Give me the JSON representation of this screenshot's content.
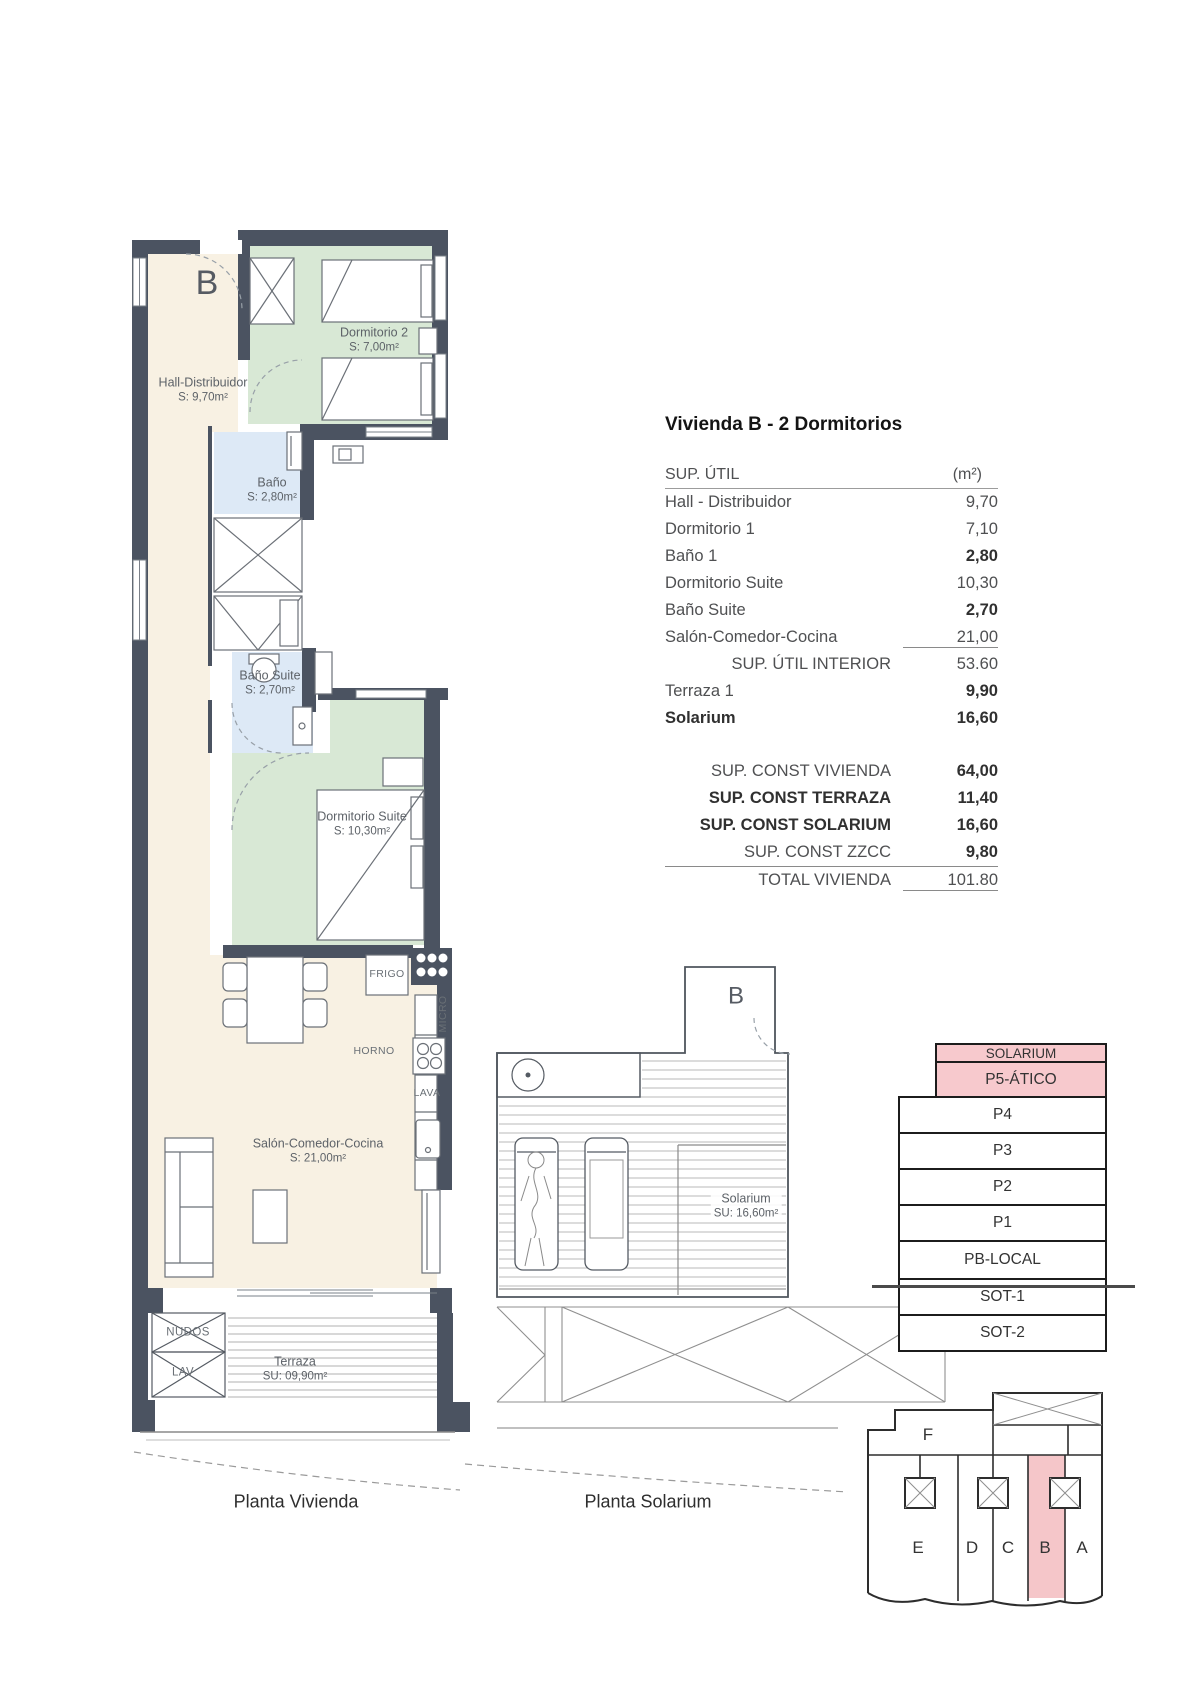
{
  "title": "Vivienda B - 2 Dormitorios",
  "plan_vivienda": {
    "caption": "Planta Vivienda",
    "unit_letter": "B",
    "hall": {
      "name": "Hall-Distribuidor",
      "area": "S: 9,70m²"
    },
    "dorm2": {
      "name": "Dormitorio 2",
      "area": "S: 7,00m²"
    },
    "bano": {
      "name": "Baño",
      "area": "S: 2,80m²"
    },
    "bano_suite": {
      "name": "Baño Suite",
      "area": "S: 2,70m²"
    },
    "dorm_suite": {
      "name": "Dormitorio Suite",
      "area": "S: 10,30m²"
    },
    "salon": {
      "name": "Salón-Comedor-Cocina",
      "area": "S: 21,00m²"
    },
    "terraza": {
      "name": "Terraza",
      "area": "SU: 09,90m²"
    },
    "kitchen_labels": {
      "frigo": "FRIGO",
      "micro": "MICRO",
      "horno": "HORNO",
      "lava": "LAVA"
    },
    "shafts": {
      "top": "NUDOS",
      "bottom": "LAV"
    }
  },
  "plan_solarium": {
    "caption": "Planta Solarium",
    "unit_letter": "B",
    "room": {
      "name": "Solarium",
      "area": "SU: 16,60m²"
    }
  },
  "surface_table": {
    "header": {
      "label": "SUP. ÚTIL",
      "unit": "(m²)"
    },
    "util_rows": [
      {
        "label": "Hall - Distribuidor",
        "value": "9,70"
      },
      {
        "label": "Dormitorio 1",
        "value": "7,10"
      },
      {
        "label": "Baño 1",
        "value": "2,80"
      },
      {
        "label": "Dormitorio Suite",
        "value": "10,30"
      },
      {
        "label": "Baño Suite",
        "value": "2,70"
      },
      {
        "label": "Salón-Comedor-Cocina",
        "value": "21,00"
      },
      {
        "label": "SUP. ÚTIL INTERIOR",
        "value": "53.60"
      },
      {
        "label": "Terraza 1",
        "value": "9,90"
      },
      {
        "label": "Solarium",
        "value": "16,60"
      }
    ],
    "const_rows": [
      {
        "label": "SUP. CONST VIVIENDA",
        "value": "64,00"
      },
      {
        "label": "SUP. CONST TERRAZA",
        "value": "11,40"
      },
      {
        "label": "SUP. CONST SOLARIUM",
        "value": "16,60"
      },
      {
        "label": "SUP. CONST ZZCC",
        "value": "9,80"
      },
      {
        "label": "TOTAL VIVIENDA",
        "value": "101.80"
      }
    ]
  },
  "floor_stack": {
    "levels": [
      {
        "label": "SOLARIUM",
        "highlight": true
      },
      {
        "label": "P5-ÁTICO",
        "highlight": true
      },
      {
        "label": "P4",
        "highlight": false
      },
      {
        "label": "P3",
        "highlight": false
      },
      {
        "label": "P2",
        "highlight": false
      },
      {
        "label": "P1",
        "highlight": false
      },
      {
        "label": "PB-LOCAL",
        "highlight": false
      },
      {
        "label": "SOT-1",
        "highlight": false
      },
      {
        "label": "SOT-2",
        "highlight": false
      }
    ]
  },
  "key_plan": {
    "top_unit": "F",
    "units": [
      "E",
      "D",
      "C",
      "B",
      "A"
    ],
    "highlighted": "B"
  },
  "colors": {
    "wall": "#4b5361",
    "cream": "#f8f1e3",
    "green": "#d8e8d5",
    "blue": "#dde9f6",
    "pink": "#f7c9cd"
  }
}
